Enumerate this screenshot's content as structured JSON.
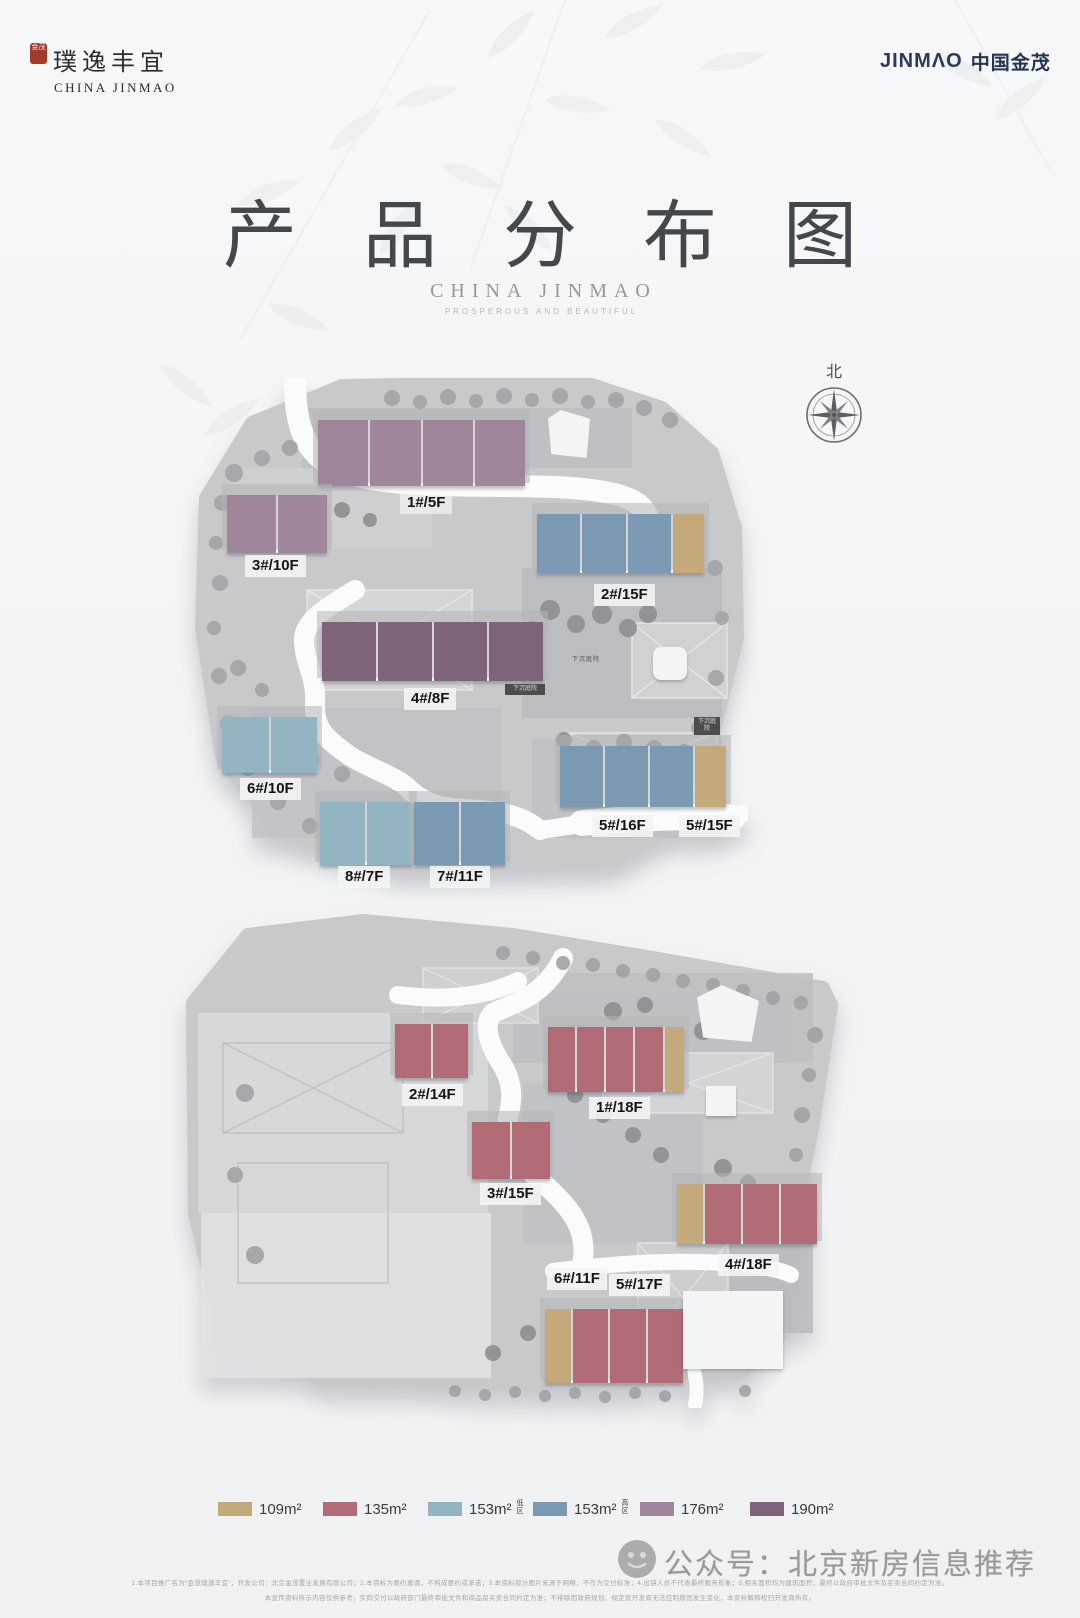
{
  "colors": {
    "a109": "#c4a97b",
    "a135": "#b16b74",
    "a153_low": "#93b5c1",
    "a153_high": "#7b99b2",
    "a176": "#a0869b",
    "a190": "#7d6478"
  },
  "header": {
    "brand_cn": "璞逸丰宜",
    "brand_en": "CHINA JINMAO",
    "seal_text": "金茂",
    "jinmao_en": "JINMΛO",
    "jinmao_cn": "中国金茂"
  },
  "title": {
    "main": "产品分布图",
    "sub": "CHINA JINMAO",
    "tagline": "PROSPEROUS AND BEAUTIFUL"
  },
  "compass": {
    "label": "北"
  },
  "labels": {
    "u1": "1#/5F",
    "u2": "2#/15F",
    "u3": "3#/10F",
    "u4": "4#/8F",
    "u5a": "5#/16F",
    "u5b": "5#/15F",
    "u6": "6#/10F",
    "u7": "7#/11F",
    "u8": "8#/7F",
    "l1": "1#/18F",
    "l2": "2#/14F",
    "l3": "3#/15F",
    "l4": "4#/18F",
    "l5": "5#/17F",
    "l6": "6#/11F"
  },
  "annotations": {
    "sunken": "下沉庭院"
  },
  "units": {
    "u1": [
      "a176",
      "a176",
      "a176",
      "a176"
    ],
    "u2": [
      "a153_high",
      "a153_high",
      "a153_high",
      "a109"
    ],
    "u3": [
      "a176",
      "a176"
    ],
    "u4": [
      "a190",
      "a190",
      "a190",
      "a190"
    ],
    "u5": [
      "a153_high",
      "a153_high",
      "a153_high",
      "a109"
    ],
    "u6": [
      "a153_low",
      "a153_low"
    ],
    "u7": [
      "a153_high",
      "a153_high"
    ],
    "u8": [
      "a153_low",
      "a153_low"
    ],
    "l1": [
      "a135",
      "a135",
      "a135",
      "a135",
      "a109"
    ],
    "l2": [
      "a135",
      "a135"
    ],
    "l3": [
      "a135",
      "a135"
    ],
    "l4": [
      "a109",
      "a135",
      "a135",
      "a135"
    ],
    "l5b": [
      "a109",
      "a135",
      "a135",
      "a135"
    ]
  },
  "legend": {
    "items": [
      {
        "key": "a109",
        "label": "109m²"
      },
      {
        "key": "a135",
        "label": "135m²"
      },
      {
        "key": "a153_low",
        "label": "153m²",
        "tag": "低区"
      },
      {
        "key": "a153_high",
        "label": "153m²",
        "tag": "高区"
      },
      {
        "key": "a176",
        "label": "176m²"
      },
      {
        "key": "a190",
        "label": "190m²"
      }
    ]
  },
  "footer": {
    "watermark": "公众号：北京新房信息推荐",
    "disclaimer1": "1.本项目推广名为“金茂璞逸丰宜”，开发公司：北京金茂置业发展有限公司；2.本资料为要约邀请，不构成要约或承诺；3.本资料部分图片来源于网络，不作为交付标准；4.出镜人员不代表最终服务形象；5.相关面积均为建筑面积，最终以政府审批文件及买卖合同约定为准。",
    "disclaimer2": "本宣传资料所示内容仅供参考，实际交付以政府部门最终审批文件和商品房买卖合同约定为准；不排除因政府规划、规定及开发商无法控制原因发生变化，本资料解释权归开发商所有。"
  }
}
